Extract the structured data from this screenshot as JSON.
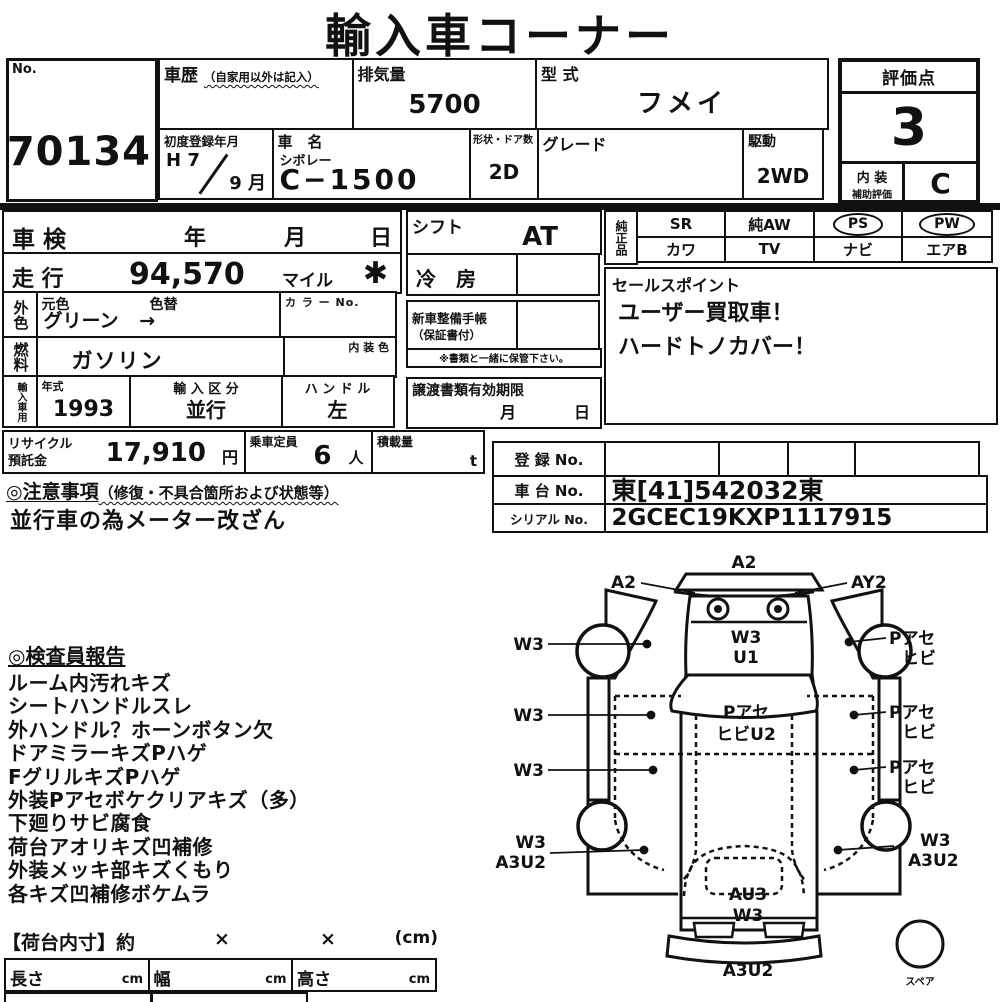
{
  "title": "輸入車コーナー",
  "colors": {
    "ink": "#111111",
    "paper": "#ffffff"
  },
  "top": {
    "no_label": "No.",
    "no_value": "70134",
    "history_label": "車歴",
    "history_note": "（自家用以外は記入）",
    "displacement_label": "排気量",
    "displacement_value": "5700",
    "model_label": "型 式",
    "model_value": "フメイ",
    "first_reg_label": "初度登録年月",
    "first_reg_year": "H 7",
    "first_reg_month": "9 月",
    "name_label": "車　名",
    "maker": "シボレー",
    "model_name": "C−1500",
    "doors_label": "形状・ドア数",
    "doors_value": "2D",
    "grade_label": "グレード",
    "drive_label": "駆動",
    "drive_value": "2WD",
    "score_label": "評価点",
    "score_value": "3",
    "interior_line1": "内 装",
    "interior_line2": "補助評価",
    "interior_grade": "C"
  },
  "left": {
    "shaken_label": "車 検",
    "shaken_year": "年",
    "shaken_month": "月",
    "shaken_day": "日",
    "mileage_label": "走 行",
    "mileage_value": "94,570",
    "mileage_unit": "マイル",
    "mileage_mark": "✱",
    "ext_color_chars": "外色",
    "orig_color_label": "元色",
    "repaint_label": "色替",
    "color_value": "グリーン",
    "color_arrow": "→",
    "color_no_label": "カ ラ ー No.",
    "fuel_chars": "燃料",
    "fuel_value": "ガソリン",
    "interior_color_label": "内 装 色",
    "import_chars": "輸入車用",
    "year_label": "年式",
    "year_value": "1993",
    "import_type_label": "輸 入 区 分",
    "import_type_value": "並行",
    "handle_label": "ハ ン ド ル",
    "handle_value": "左"
  },
  "center": {
    "shift_label": "シフト",
    "shift_value": "AT",
    "ac_label": "冷　房",
    "service_book_label": "新車整備手帳",
    "service_book_note": "（保証書付）",
    "keep_note": "※書類と一緒に保管下さい。",
    "transfer_label": "譲渡書類有効期限",
    "transfer_month": "月",
    "transfer_day": "日"
  },
  "right": {
    "genuine_chars": "純正品",
    "equip_row1": [
      "SR",
      "純AW",
      "PS",
      "PW"
    ],
    "equip_row2": [
      "カワ",
      "TV",
      "ナビ",
      "エアB"
    ],
    "circled": [
      "PS",
      "PW"
    ],
    "sales_label": "セールスポイント",
    "sales_lines": [
      "ユーザー買取車！",
      "ハードトノカバー！"
    ]
  },
  "reg": {
    "recycle_label1": "リサイクル",
    "recycle_label2": "預託金",
    "recycle_value": "17,910",
    "recycle_unit": "円",
    "capacity_label": "乗車定員",
    "capacity_value": "6",
    "capacity_unit": "人",
    "payload_label": "積載量",
    "payload_unit": "t",
    "reg_no_label": "登 録 No.",
    "chassis_label": "車 台 No.",
    "chassis_value": "東[41]542032東",
    "serial_label": "シリアル No.",
    "serial_value": "2GCEC19KXP1117915"
  },
  "notes": {
    "header": "◎注意事項",
    "header_note": "（修復・不具合箇所および状態等）",
    "line": "並行車の為メーター改ざん"
  },
  "inspection": {
    "header": "◎検査員報告",
    "items": [
      "ルーム内汚れキズ",
      "シートハンドルスレ",
      "外ハンドル？ホーンボタン欠",
      "ドアミラーキズPハゲ",
      "FグリルキズPハゲ",
      "外装Pアセボケクリアキズ（多）",
      "下廻りサビ腐食",
      "荷台アオリキズ凹補修",
      "外装メッキ部キズくもり",
      "各キズ凹補修ボケムラ"
    ]
  },
  "bed": {
    "header": "【荷台内寸】約",
    "times1": "×",
    "times2": "×",
    "unit": "(cm)",
    "len_label": "長さ",
    "len_unit": "cm",
    "width_label": "幅",
    "width_unit": "cm",
    "height_label": "高さ",
    "height_unit": "cm"
  },
  "diagram": {
    "front_center": "A2",
    "front_left": "A2",
    "front_right": "AY2",
    "hood1": "W3",
    "hood2": "U1",
    "windshield1": "Pアセ",
    "windshield2": "ヒビU2",
    "left1": "W3",
    "left2": "W3",
    "left3": "W3",
    "right1a": "Pアセ",
    "right1b": "ヒビ",
    "right2a": "Pアセ",
    "right2b": "ヒビ",
    "right3a": "Pアセ",
    "right3b": "ヒビ",
    "rear_left1": "W3",
    "rear_left2": "A3U2",
    "rear_right1": "W3",
    "rear_right2": "A3U2",
    "bed1": "AU3",
    "bed2": "W3",
    "rear_bumper": "A3U2",
    "spare": "スペア"
  }
}
